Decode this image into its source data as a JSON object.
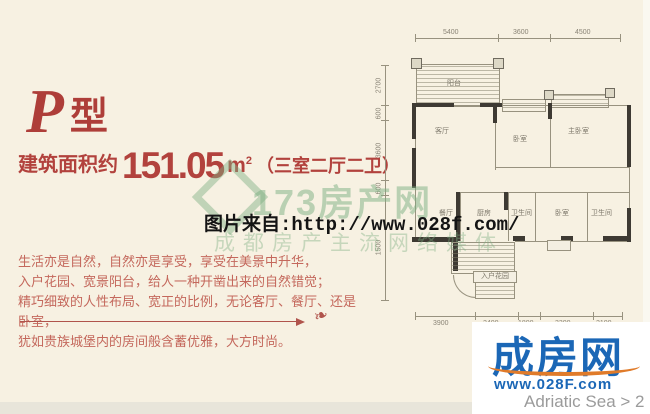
{
  "colors": {
    "background": "#f7f1e2",
    "accent_red": "#b2423d",
    "paragraph_red": "#c4685c",
    "watermark_green": "#7cb082",
    "logo_blue": "#1b67b6",
    "logo_orange": "#e07b2a"
  },
  "header": {
    "type_letter": "P",
    "type_suffix": "型"
  },
  "area": {
    "prefix": "建筑面积约",
    "value": "151.05",
    "unit": "m",
    "unit_sup": "2",
    "layout": "（三室二厅二卫）"
  },
  "description": {
    "lines": [
      "生活亦是自然，自然亦是享受，享受在美景中升华，",
      "入户花园、宽景阳台，给人一种开凿出来的自然错觉；",
      "精巧细致的人性布局、宽正的比例，无论客厅、餐厅、还是卧室，",
      "犹如贵族城堡内的房间般含蓄优雅，大方时尚。"
    ]
  },
  "watermarks": {
    "green_brand": "173房产网",
    "green_tagline": "成都房产主流网络媒体",
    "source_label": "图片来自:http://www.028f.com/"
  },
  "floorplan": {
    "rooms": {
      "balcony": "阳台",
      "living": "客厅",
      "bedroom": "卧室",
      "master": "主卧室",
      "dining": "餐厅",
      "kitchen": "厨房",
      "bath1": "卫生间",
      "bedroom2": "卧室",
      "bath2": "卫生间",
      "entry_garden": "入户花园"
    },
    "top_dims": [
      "5400",
      "3600",
      "4500"
    ],
    "left_dims": [
      "2700",
      "600",
      "3600",
      "600",
      "1500"
    ],
    "bottom_dims": [
      "3900",
      "2400",
      "1800",
      "3300",
      "2100"
    ]
  },
  "logo": {
    "brand": "成房网",
    "url": "www.028F.com",
    "caption": "Adriatic Sea > 2"
  }
}
